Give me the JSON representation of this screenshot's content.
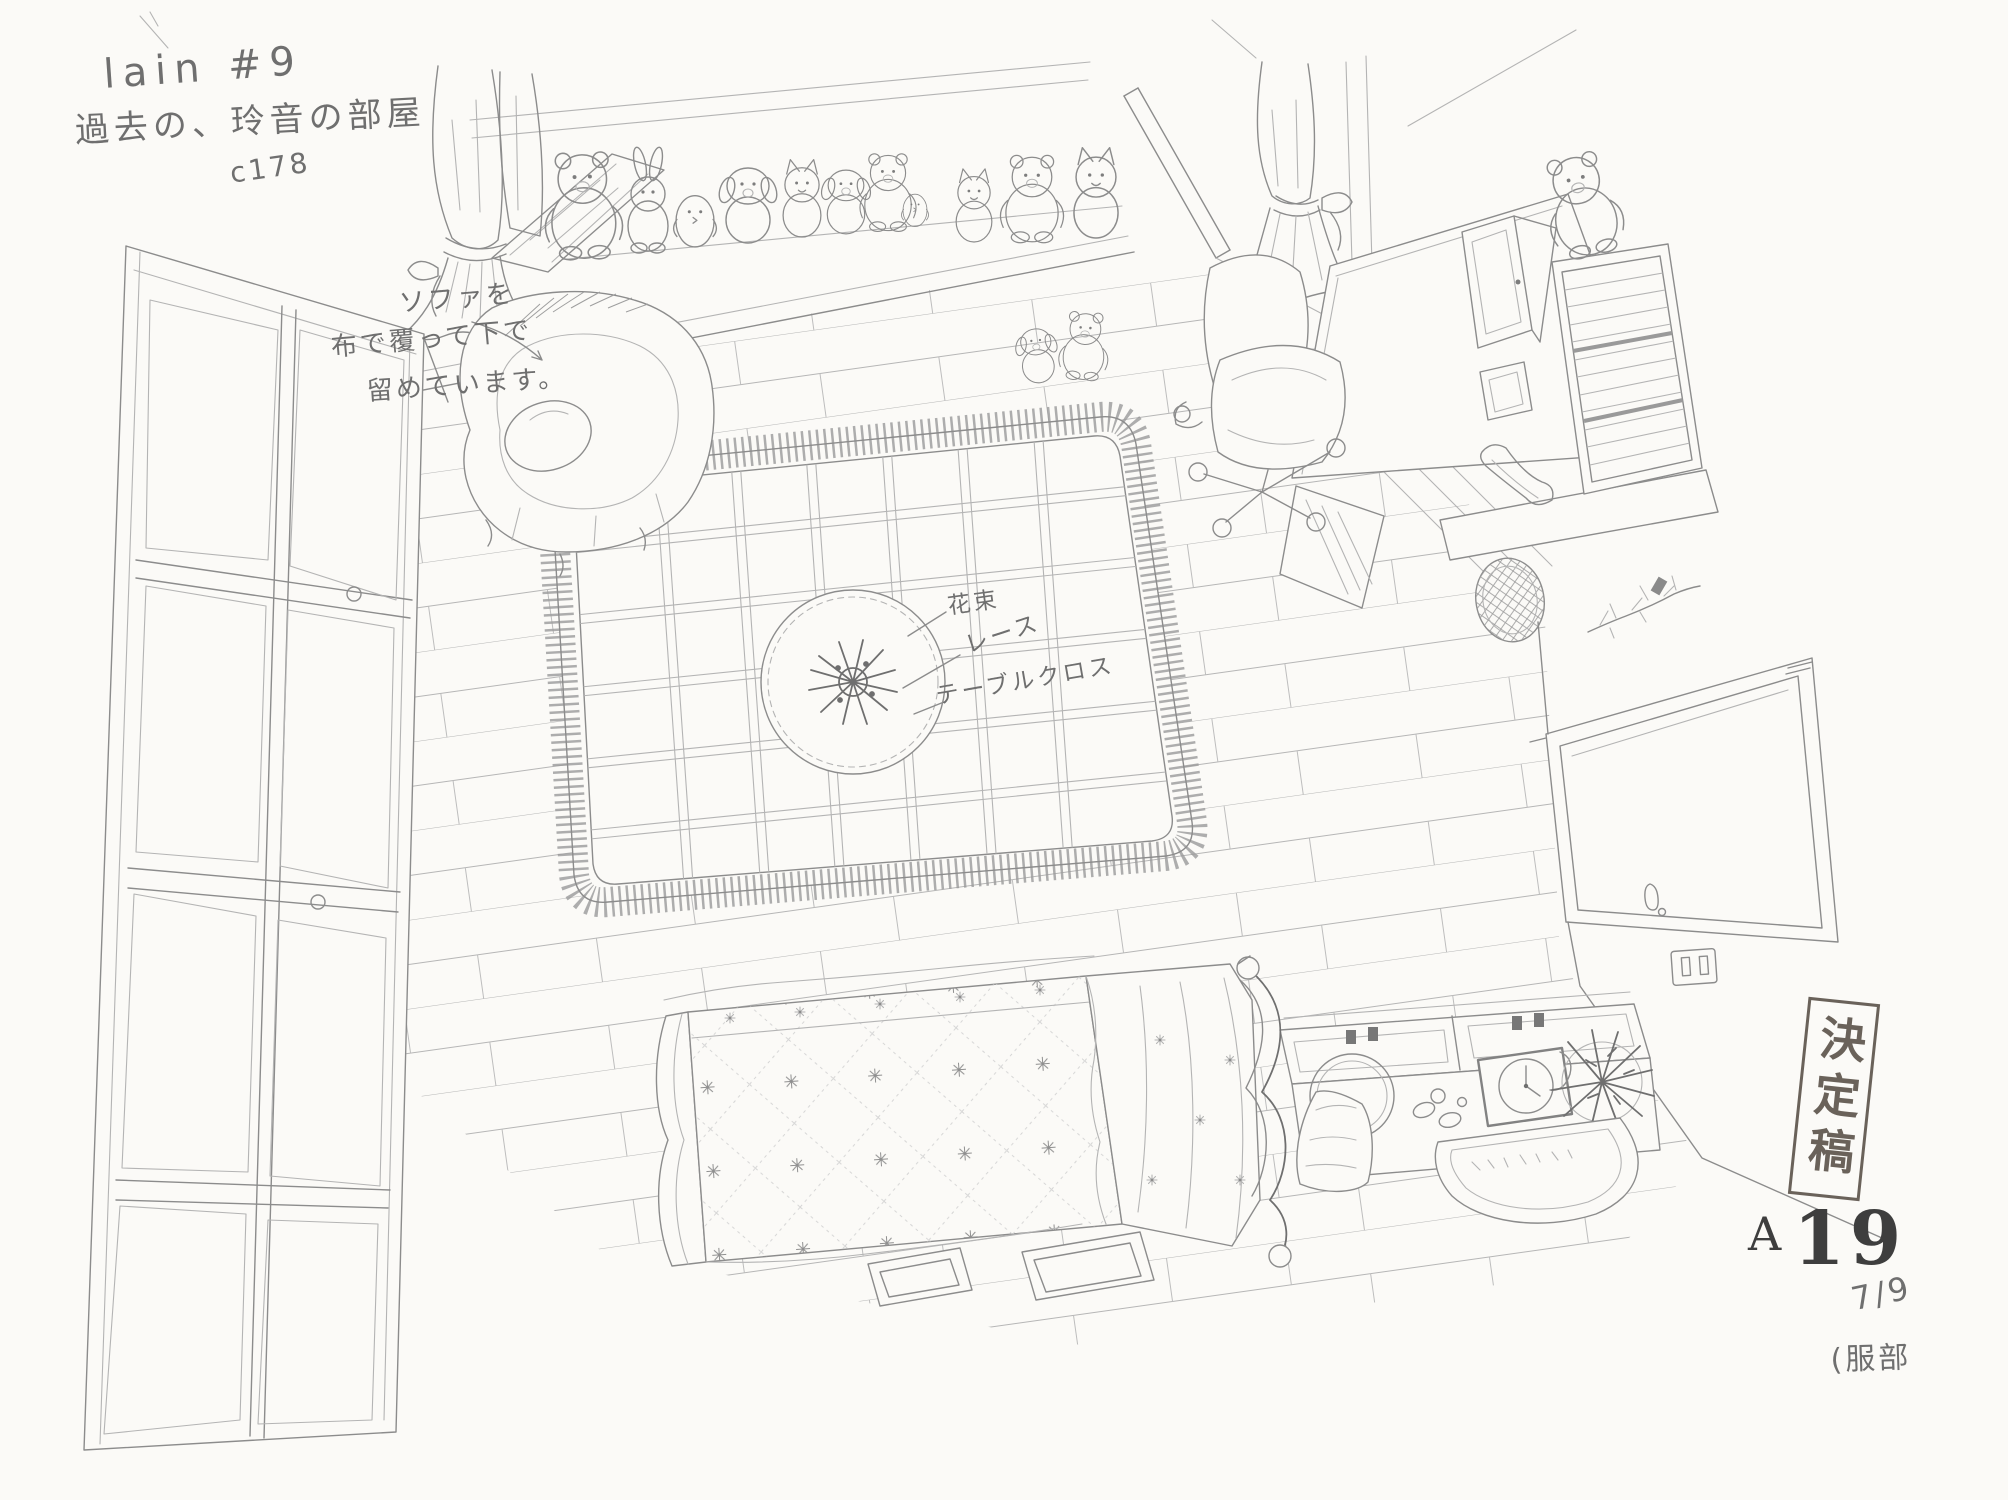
{
  "header": {
    "production": "lain #9",
    "scene": "過去の、玲音の部屋",
    "cut": "c178"
  },
  "notes": {
    "sofa": [
      "ソファを",
      "布で覆って下で",
      "留めています。"
    ]
  },
  "labels": {
    "bouquet": "花束",
    "lace": "レース",
    "tablecloth": "テーブルクロス"
  },
  "approval": {
    "stamp": "決定稿",
    "page_letter": "A",
    "page_number": "19",
    "date": "7/9",
    "signature": "(服部"
  },
  "colors": {
    "paper": "#fbfaf7",
    "pencil": "#8c8c8c",
    "pencil_light": "#b4b4b4",
    "pencil_dark": "#6f6f6f",
    "stamp_ink": "#6a625a"
  }
}
